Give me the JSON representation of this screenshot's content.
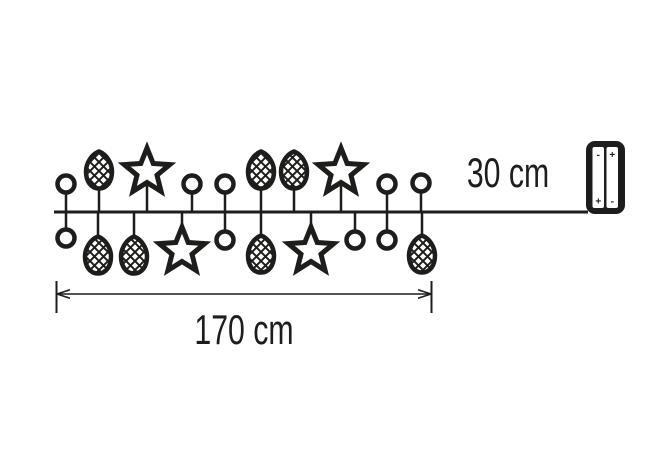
{
  "page": {
    "background": "#ffffff"
  },
  "colors": {
    "ink": "#1d1d1b",
    "paper": "#ffffff"
  },
  "labels": {
    "lead_length": "30 cm",
    "garland_length": "170 cm"
  },
  "battery": {
    "cells": [
      {
        "top": "-",
        "bottom": "+"
      },
      {
        "top": "+",
        "bottom": "-"
      }
    ]
  },
  "diagram": {
    "wire": {
      "x1": 54,
      "x2": 588,
      "y": 212
    },
    "ornaments": {
      "top": [
        {
          "type": "ball",
          "x": 66,
          "y": 184
        },
        {
          "type": "pinecone",
          "x": 99,
          "y": 170
        },
        {
          "type": "star",
          "x": 147,
          "y": 172
        },
        {
          "type": "ball",
          "x": 192,
          "y": 184
        },
        {
          "type": "ball",
          "x": 225,
          "y": 184
        },
        {
          "type": "pinecone",
          "x": 261,
          "y": 170
        },
        {
          "type": "pinecone",
          "x": 294,
          "y": 170
        },
        {
          "type": "star",
          "x": 341,
          "y": 172
        },
        {
          "type": "ball",
          "x": 387,
          "y": 184
        },
        {
          "type": "ball",
          "x": 421,
          "y": 183
        }
      ],
      "bottom": [
        {
          "type": "ball",
          "x": 66,
          "y": 238
        },
        {
          "type": "pinecone",
          "x": 98,
          "y": 255
        },
        {
          "type": "pinecone",
          "x": 134,
          "y": 255
        },
        {
          "type": "star",
          "x": 182,
          "y": 251
        },
        {
          "type": "ball",
          "x": 225,
          "y": 240
        },
        {
          "type": "pinecone",
          "x": 261,
          "y": 254
        },
        {
          "type": "star",
          "x": 311,
          "y": 251
        },
        {
          "type": "ball",
          "x": 355,
          "y": 240
        },
        {
          "type": "ball",
          "x": 387,
          "y": 240
        },
        {
          "type": "pinecone",
          "x": 422,
          "y": 254
        }
      ]
    },
    "dimension": {
      "x1": 56,
      "x2": 432,
      "y": 294,
      "tick_top": 281,
      "tick_bottom": 313
    },
    "battery_box": {
      "x": 586,
      "y": 141,
      "w": 39,
      "h": 73
    }
  }
}
